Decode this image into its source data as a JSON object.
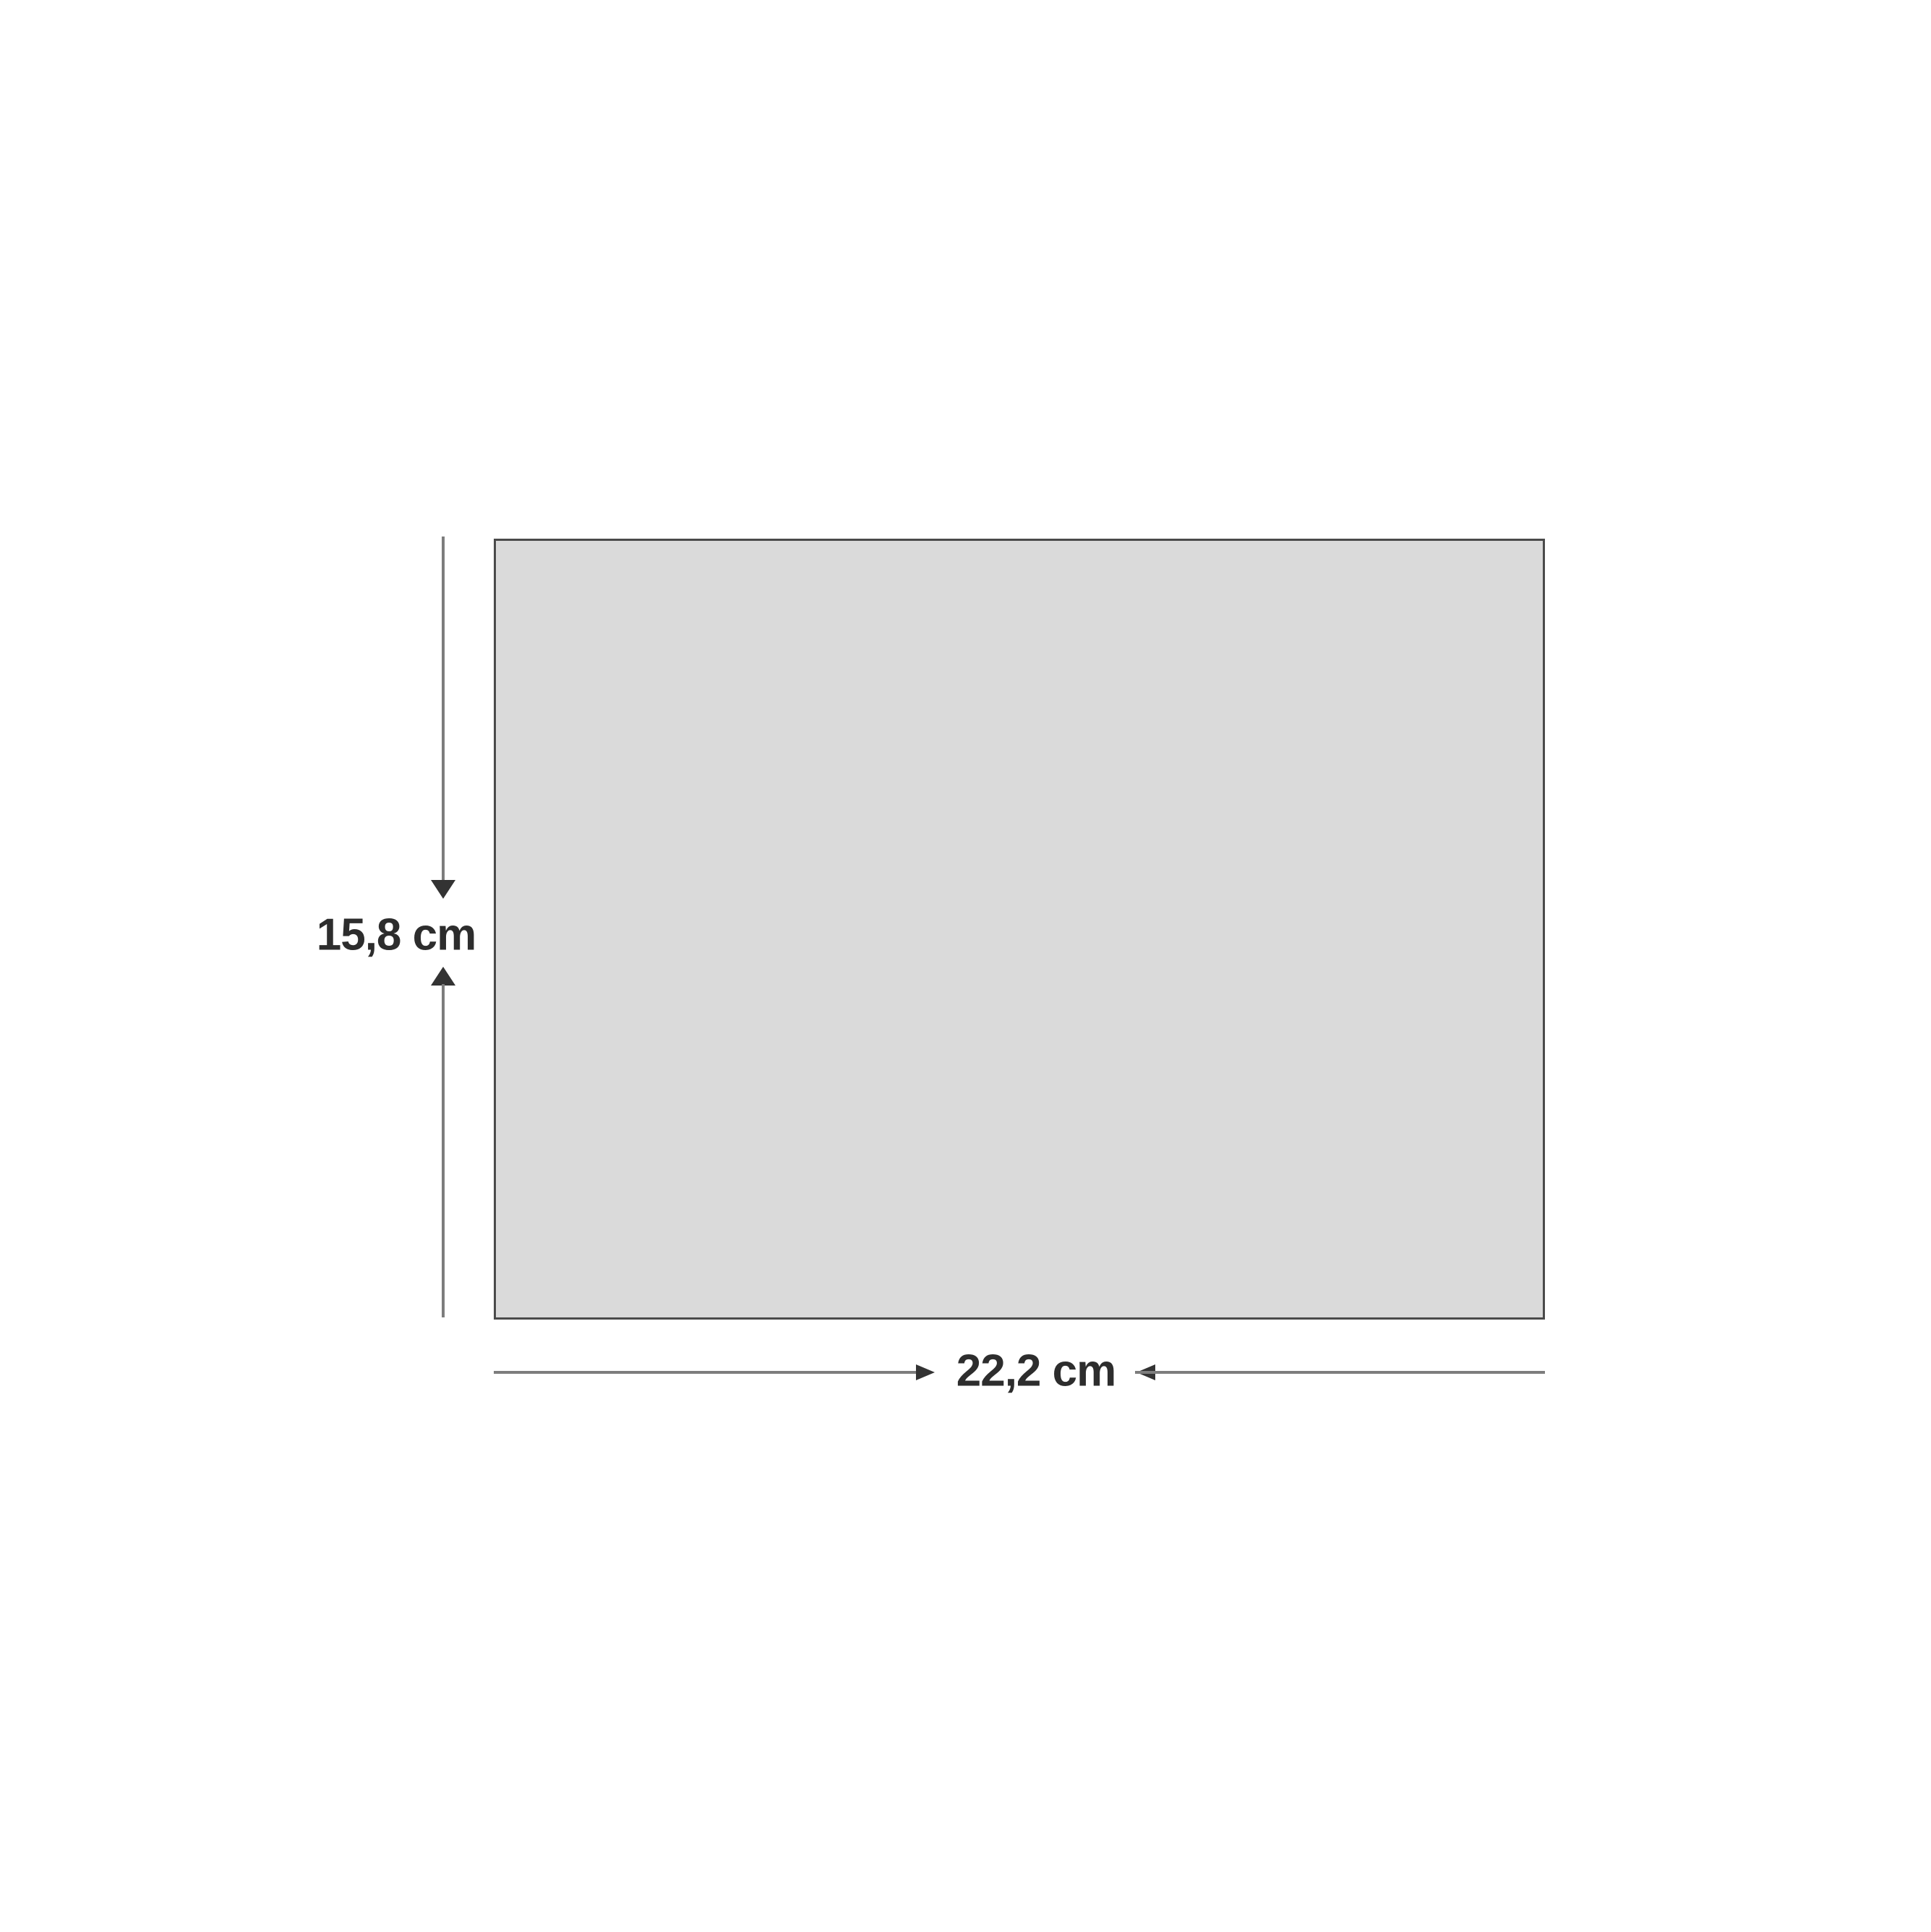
{
  "figure": {
    "shape": "rectangle",
    "height_label": "15,8 cm",
    "width_label": "22,2 cm"
  },
  "icons": {
    "height_dimension_arrows": [
      "arrow-down-icon",
      "arrow-up-icon"
    ],
    "width_dimension_arrows": [
      "arrow-right-icon",
      "arrow-left-icon"
    ]
  },
  "colors": {
    "bg": "#ffffff",
    "fill": "#dadada",
    "border": "#4a4a4a",
    "line": "#7d7d7d",
    "arrow": "#333333",
    "text": "#2d2d2d"
  }
}
